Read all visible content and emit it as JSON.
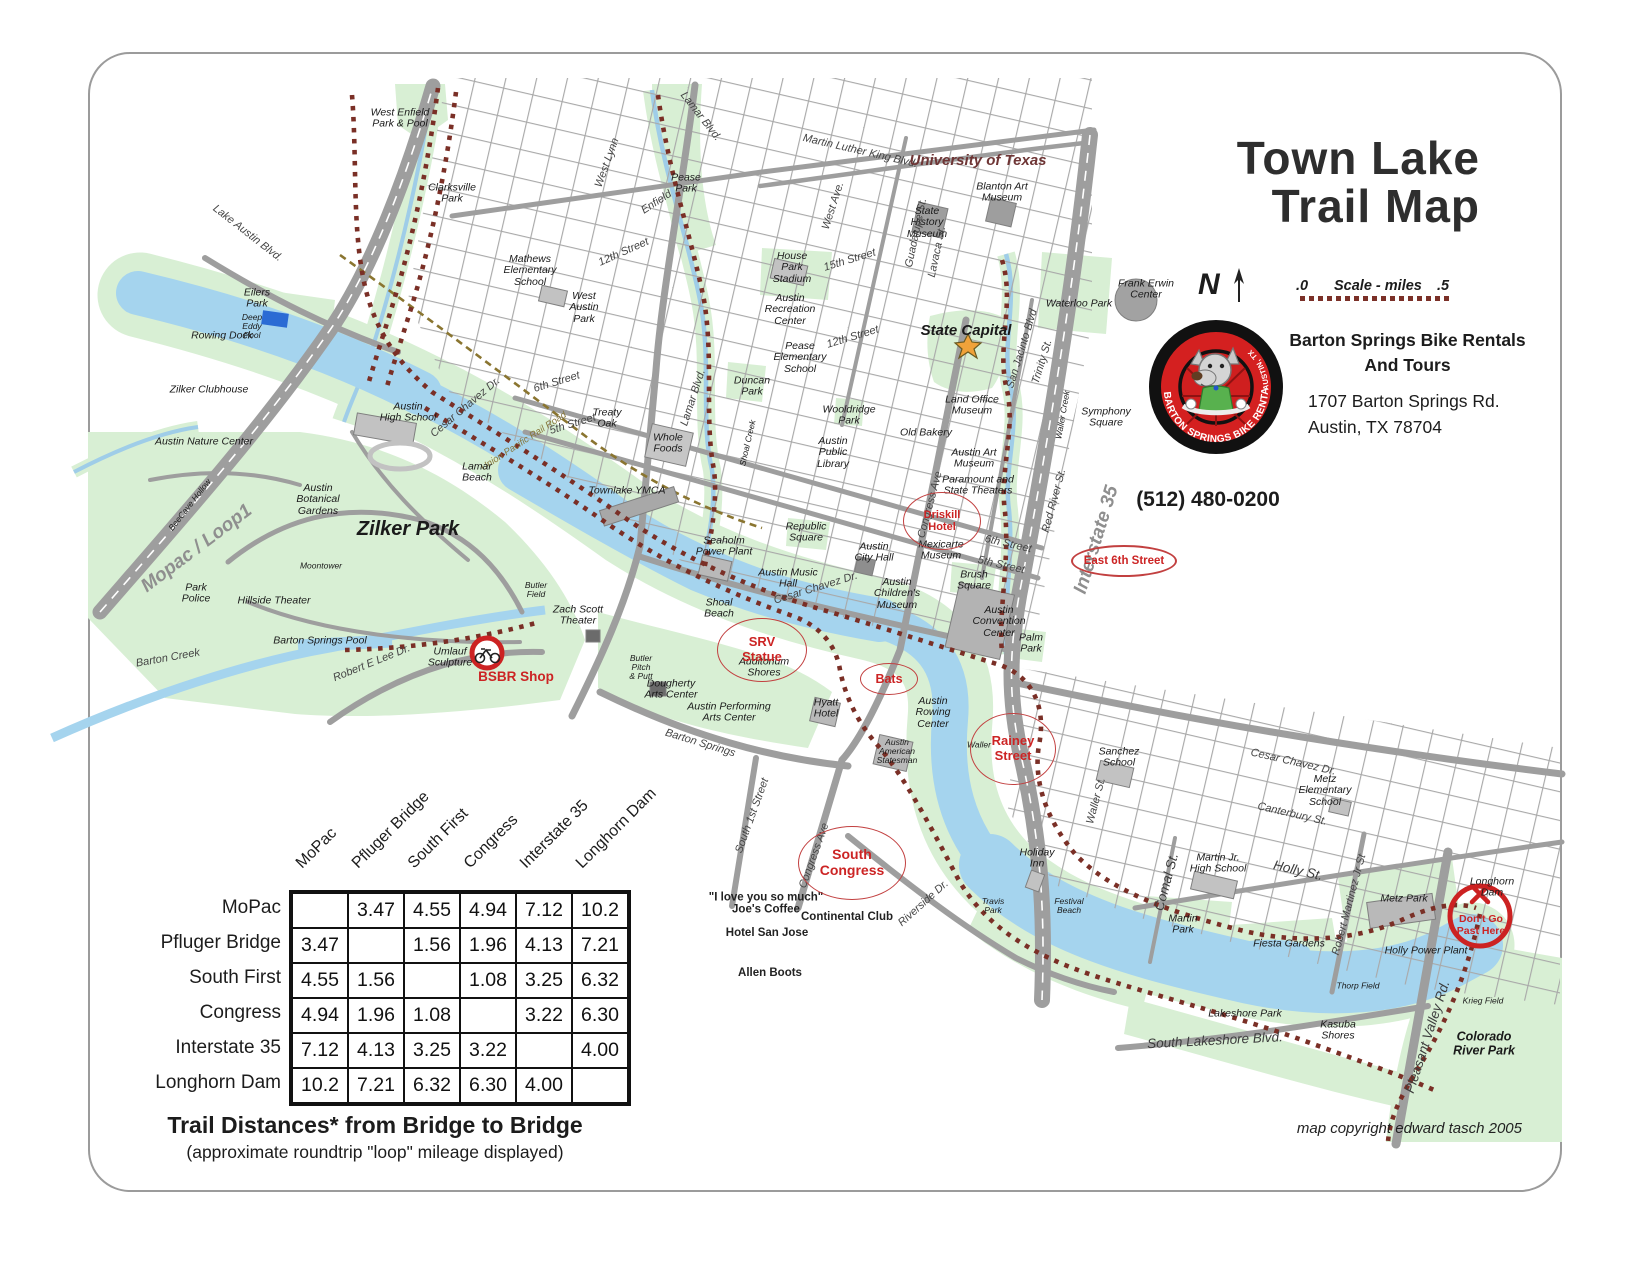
{
  "title": {
    "line1": "Town Lake",
    "line2": "Trail Map"
  },
  "compass": {
    "label": "N"
  },
  "scale": {
    "start": ".0",
    "label": "Scale - miles",
    "end": ".5"
  },
  "business": {
    "logo_ring_text": "BARTON SPRINGS BIKE RENTAL",
    "logo_side_text": "AUSTIN, TX",
    "name_line1": "Barton Springs Bike Rentals",
    "name_line2": "And Tours",
    "address_line1": "1707 Barton Springs Rd.",
    "address_line2": "Austin, TX 78704",
    "phone": "(512) 480-0200"
  },
  "distance_table": {
    "locations": [
      "MoPac",
      "Pfluger Bridge",
      "South First",
      "Congress",
      "Interstate 35",
      "Longhorn Dam"
    ],
    "matrix": [
      [
        "",
        "3.47",
        "4.55",
        "4.94",
        "7.12",
        "10.2"
      ],
      [
        "3.47",
        "",
        "1.56",
        "1.96",
        "4.13",
        "7.21"
      ],
      [
        "4.55",
        "1.56",
        "",
        "1.08",
        "3.25",
        "6.32"
      ],
      [
        "4.94",
        "1.96",
        "1.08",
        "",
        "3.22",
        "6.30"
      ],
      [
        "7.12",
        "4.13",
        "3.25",
        "3.22",
        "",
        "4.00"
      ],
      [
        "10.2",
        "7.21",
        "6.32",
        "6.30",
        "4.00",
        ""
      ]
    ],
    "caption": "Trail Distances* from Bridge to Bridge",
    "subcaption": "(approximate roundtrip \"loop\" mileage displayed)"
  },
  "copyright": "map copyright edward tasch 2005",
  "map": {
    "colors": {
      "water": "#a5d4ee",
      "park": "#d8efd4",
      "road": "#9e9e9e",
      "trail": "#7a2f26",
      "callout": "#cc2424"
    },
    "shop_marker": {
      "label": "BSBR Shop",
      "x": 516,
      "y": 678
    },
    "warning_marker": {
      "label": "Don't Go\nPast Here",
      "x": 1481,
      "y": 925
    },
    "callouts": [
      {
        "t": "Driskill\nHotel",
        "x": 941,
        "y": 520,
        "w": 76,
        "h": 56,
        "fs": 11,
        "bw": 1.3
      },
      {
        "t": "East 6th Street",
        "x": 1122,
        "y": 559,
        "w": 102,
        "h": 28,
        "fs": 11.5,
        "bw": 2.5
      },
      {
        "t": "SRV\nStatue",
        "x": 761,
        "y": 649,
        "w": 88,
        "h": 62,
        "fs": 13,
        "bw": 1.3
      },
      {
        "t": "Bats",
        "x": 888,
        "y": 678,
        "w": 56,
        "h": 30,
        "fs": 12.5,
        "bw": 1.4
      },
      {
        "t": "Rainey\nStreet",
        "x": 1012,
        "y": 748,
        "w": 84,
        "h": 70,
        "fs": 13,
        "bw": 1.4
      },
      {
        "t": "South\nCongress",
        "x": 851,
        "y": 862,
        "w": 106,
        "h": 72,
        "fs": 14,
        "bw": 1.7
      }
    ],
    "labels": [
      {
        "t": "West Enfield\nPark & Pool",
        "x": 400,
        "y": 119
      },
      {
        "t": "Clarksville\nPark",
        "x": 452,
        "y": 194
      },
      {
        "t": "Pease\nPark",
        "x": 686,
        "y": 184
      },
      {
        "t": "Lamar Blvd.",
        "x": 700,
        "y": 117,
        "r": 52,
        "c": "rd"
      },
      {
        "t": "West Lynn",
        "x": 608,
        "y": 163,
        "r": -70,
        "c": "rd"
      },
      {
        "t": "Enfield",
        "x": 657,
        "y": 203,
        "r": -33,
        "c": "rd"
      },
      {
        "t": "12th Street",
        "x": 624,
        "y": 253,
        "r": -24,
        "c": "rd"
      },
      {
        "t": "Mathews\nElementary\nSchool",
        "x": 530,
        "y": 271
      },
      {
        "t": "West\nAustin\nPark",
        "x": 584,
        "y": 308
      },
      {
        "t": "Martin Luther King Blvd.",
        "x": 860,
        "y": 152,
        "r": 13,
        "c": "rd"
      },
      {
        "t": "University of Texas",
        "x": 978,
        "y": 161,
        "c": "maroon"
      },
      {
        "t": "Blanton Art\nMuseum",
        "x": 1002,
        "y": 193
      },
      {
        "t": "State\nHistory\nMuseum",
        "x": 927,
        "y": 223
      },
      {
        "t": "West Ave.",
        "x": 834,
        "y": 206,
        "r": -72,
        "c": "rd"
      },
      {
        "t": "15th Street",
        "x": 850,
        "y": 261,
        "r": -17,
        "c": "rd"
      },
      {
        "t": "House\nPark\nStadium",
        "x": 792,
        "y": 268
      },
      {
        "t": "Guadalupe St.",
        "x": 917,
        "y": 233,
        "r": -78,
        "c": "rd"
      },
      {
        "t": "Lavaca St.",
        "x": 938,
        "y": 252,
        "r": -78,
        "c": "rd"
      },
      {
        "t": "Austin\nRecreation\nCenter",
        "x": 790,
        "y": 310
      },
      {
        "t": "Waterloo Park",
        "x": 1079,
        "y": 304
      },
      {
        "t": "Frank Erwin\nCenter",
        "x": 1146,
        "y": 290
      },
      {
        "t": "State Capital",
        "x": 966,
        "y": 331,
        "c": "lg"
      },
      {
        "t": "12th Street",
        "x": 853,
        "y": 338,
        "r": -17,
        "c": "rd"
      },
      {
        "t": "Pease\nElementary\nSchool",
        "x": 800,
        "y": 358
      },
      {
        "t": "San Jacinto Blvd",
        "x": 1023,
        "y": 349,
        "r": -73,
        "c": "rd"
      },
      {
        "t": "Trinity St.",
        "x": 1043,
        "y": 362,
        "r": -73,
        "c": "rd"
      },
      {
        "t": "Symphony\nSquare",
        "x": 1106,
        "y": 418
      },
      {
        "t": "Waller Creek",
        "x": 1063,
        "y": 415,
        "r": -80,
        "c": "xs"
      },
      {
        "t": "Lake Austin Blvd.",
        "x": 247,
        "y": 234,
        "r": 38,
        "c": "rd"
      },
      {
        "t": "Eilers\nPark",
        "x": 257,
        "y": 299
      },
      {
        "t": "Deep\nEddy\nPool",
        "x": 252,
        "y": 327,
        "c": "xs"
      },
      {
        "t": "Rowing Dock",
        "x": 222,
        "y": 336
      },
      {
        "t": "Zilker Clubhouse",
        "x": 209,
        "y": 390
      },
      {
        "t": "Austin Nature Center",
        "x": 204,
        "y": 442
      },
      {
        "t": "Austin\nHigh School",
        "x": 408,
        "y": 413
      },
      {
        "t": "Cesar Chavez Dr.",
        "x": 466,
        "y": 408,
        "r": -40,
        "c": "rd"
      },
      {
        "t": "Union Pacific Rail Road",
        "x": 524,
        "y": 442,
        "r": -33,
        "c": "rr"
      },
      {
        "t": "BeeCave Hollow",
        "x": 190,
        "y": 505,
        "r": -52,
        "c": "xs"
      },
      {
        "t": "Mopac / Loop1",
        "x": 197,
        "y": 549,
        "r": -37,
        "c": "hwy"
      },
      {
        "t": "Austin\nBotanical\nGardens",
        "x": 318,
        "y": 500
      },
      {
        "t": "Zilker Park",
        "x": 408,
        "y": 530,
        "c": "xl"
      },
      {
        "t": "Moontower",
        "x": 321,
        "y": 566,
        "c": "xs"
      },
      {
        "t": "Park\nPolice",
        "x": 196,
        "y": 594
      },
      {
        "t": "Hillside Theater",
        "x": 274,
        "y": 601
      },
      {
        "t": "Barton Springs Pool",
        "x": 320,
        "y": 641
      },
      {
        "t": "Barton Creek",
        "x": 168,
        "y": 659,
        "r": -10,
        "c": "rd"
      },
      {
        "t": "Robert E Lee Dr.",
        "x": 372,
        "y": 664,
        "r": -22,
        "c": "rd"
      },
      {
        "t": "Umlauf\nSculpture",
        "x": 450,
        "y": 658
      },
      {
        "t": "Zach Scott\nTheater",
        "x": 578,
        "y": 616
      },
      {
        "t": "Butler\nField",
        "x": 536,
        "y": 590,
        "c": "xs"
      },
      {
        "t": "Lamar\nBeach",
        "x": 477,
        "y": 473
      },
      {
        "t": "Townlake YMCA",
        "x": 627,
        "y": 491
      },
      {
        "t": "6th Street",
        "x": 557,
        "y": 383,
        "r": -17,
        "c": "rd"
      },
      {
        "t": "5th Street",
        "x": 573,
        "y": 425,
        "r": -17,
        "c": "rd"
      },
      {
        "t": "Lamar Blvd.",
        "x": 694,
        "y": 398,
        "r": -72,
        "c": "rd"
      },
      {
        "t": "Treaty\nOak",
        "x": 607,
        "y": 419
      },
      {
        "t": "Whole\nFoods",
        "x": 668,
        "y": 444
      },
      {
        "t": "Duncan\nPark",
        "x": 752,
        "y": 387
      },
      {
        "t": "Shoal Creek",
        "x": 748,
        "y": 443,
        "r": -77,
        "c": "xs"
      },
      {
        "t": "Seaholm\nPower Plant",
        "x": 724,
        "y": 547
      },
      {
        "t": "Republic\nSquare",
        "x": 806,
        "y": 533
      },
      {
        "t": "Wooldridge\nPark",
        "x": 849,
        "y": 416
      },
      {
        "t": "Austin\nPublic\nLibrary",
        "x": 833,
        "y": 453
      },
      {
        "t": "Old Bakery",
        "x": 926,
        "y": 433
      },
      {
        "t": "Land Office\nMuseum",
        "x": 972,
        "y": 406
      },
      {
        "t": "Austin Art\nMuseum",
        "x": 974,
        "y": 459
      },
      {
        "t": "Paramount and\nState Theaters",
        "x": 978,
        "y": 486
      },
      {
        "t": "Congress Ave",
        "x": 931,
        "y": 505,
        "r": -75,
        "c": "rd"
      },
      {
        "t": "Red River St.",
        "x": 1055,
        "y": 501,
        "r": -75,
        "c": "rd"
      },
      {
        "t": "Interstate 35",
        "x": 1097,
        "y": 540,
        "r": -73,
        "c": "hwy"
      },
      {
        "t": "Austin\nCity Hall",
        "x": 874,
        "y": 553
      },
      {
        "t": "Mexicarte\nMuseum",
        "x": 941,
        "y": 551
      },
      {
        "t": "6th Street",
        "x": 1008,
        "y": 545,
        "r": 13,
        "c": "rd"
      },
      {
        "t": "5th Street",
        "x": 1001,
        "y": 566,
        "r": 13,
        "c": "rd"
      },
      {
        "t": "Brush\nSquare",
        "x": 974,
        "y": 581
      },
      {
        "t": "Austin\nChildren's\nMuseum",
        "x": 897,
        "y": 594
      },
      {
        "t": "Austin\nConvention\nCenter",
        "x": 999,
        "y": 622
      },
      {
        "t": "Palm\nPark",
        "x": 1031,
        "y": 644
      },
      {
        "t": "Cesar Chavez Dr.",
        "x": 816,
        "y": 589,
        "r": -17,
        "c": "rd"
      },
      {
        "t": "Austin Music\nHall",
        "x": 788,
        "y": 579
      },
      {
        "t": "Shoal\nBeach",
        "x": 719,
        "y": 609
      },
      {
        "t": "Auditorium\nShores",
        "x": 764,
        "y": 668
      },
      {
        "t": "Hyatt\nHotel",
        "x": 826,
        "y": 709
      },
      {
        "t": "Austin\nRowing\nCenter",
        "x": 933,
        "y": 713
      },
      {
        "t": "Austin\nAmerican\nStatesman",
        "x": 897,
        "y": 752,
        "c": "xs"
      },
      {
        "t": "Dougherty\nArts Center",
        "x": 671,
        "y": 690
      },
      {
        "t": "Austin Performing\nArts Center",
        "x": 729,
        "y": 713
      },
      {
        "t": "Butler\nPitch\n& Putt",
        "x": 641,
        "y": 668,
        "c": "xs"
      },
      {
        "t": "Barton Springs",
        "x": 700,
        "y": 744,
        "r": 17,
        "c": "rd"
      },
      {
        "t": "South 1st Street",
        "x": 753,
        "y": 816,
        "r": -70,
        "c": "rd"
      },
      {
        "t": "Congress Ave",
        "x": 815,
        "y": 856,
        "r": -70,
        "c": "rd"
      },
      {
        "t": "Riverside Dr.",
        "x": 924,
        "y": 904,
        "r": -42,
        "c": "rd"
      },
      {
        "t": "\"I love you so much\"\nJoe's Coffee",
        "x": 766,
        "y": 904,
        "c": "sb"
      },
      {
        "t": "Continental Club",
        "x": 847,
        "y": 917,
        "c": "sb"
      },
      {
        "t": "Hotel San Jose",
        "x": 767,
        "y": 933,
        "c": "sb"
      },
      {
        "t": "Allen Boots",
        "x": 770,
        "y": 973,
        "c": "sb"
      },
      {
        "t": "Waller",
        "x": 979,
        "y": 745,
        "c": "xs"
      },
      {
        "t": "Holiday\nInn",
        "x": 1037,
        "y": 859
      },
      {
        "t": "Sanchez\nSchool",
        "x": 1119,
        "y": 758
      },
      {
        "t": "Waller St.",
        "x": 1097,
        "y": 801,
        "r": -75,
        "c": "rd"
      },
      {
        "t": "Cesar Chavez Dr.",
        "x": 1293,
        "y": 763,
        "r": 13,
        "c": "rd"
      },
      {
        "t": "Canterbury St.",
        "x": 1292,
        "y": 815,
        "r": 13,
        "c": "rd"
      },
      {
        "t": "Holly St.",
        "x": 1298,
        "y": 871,
        "r": 13,
        "c": "rd2"
      },
      {
        "t": "Comal St.",
        "x": 1167,
        "y": 882,
        "r": -75,
        "c": "rd2"
      },
      {
        "t": "Martin Jr.\nHigh School",
        "x": 1218,
        "y": 864
      },
      {
        "t": "Metz\nElementary\nSchool",
        "x": 1325,
        "y": 791
      },
      {
        "t": "Robert Martinez Jr St",
        "x": 1350,
        "y": 905,
        "r": -75,
        "c": "rd"
      },
      {
        "t": "Metz Park",
        "x": 1404,
        "y": 899
      },
      {
        "t": "Martin\nPark",
        "x": 1183,
        "y": 925
      },
      {
        "t": "Fiesta Gardens",
        "x": 1289,
        "y": 944
      },
      {
        "t": "Holly Power Plant",
        "x": 1426,
        "y": 951
      },
      {
        "t": "Thorp Field",
        "x": 1358,
        "y": 986,
        "c": "xs"
      },
      {
        "t": "Travis\nPark",
        "x": 993,
        "y": 906,
        "c": "xs"
      },
      {
        "t": "Festival\nBeach",
        "x": 1069,
        "y": 906,
        "c": "xs"
      },
      {
        "t": "Lakeshore Park",
        "x": 1245,
        "y": 1014
      },
      {
        "t": "South Lakeshore Blvd.",
        "x": 1215,
        "y": 1041,
        "r": -3,
        "c": "rd2"
      },
      {
        "t": "Kasuba\nShores",
        "x": 1338,
        "y": 1031
      },
      {
        "t": "Pleasant Valley Rd.",
        "x": 1428,
        "y": 1037,
        "r": -72,
        "c": "rd2"
      },
      {
        "t": "Longhorn\nDam",
        "x": 1492,
        "y": 888
      },
      {
        "t": "Krieg Field",
        "x": 1483,
        "y": 1001,
        "c": "xs"
      },
      {
        "t": "Colorado\nRiver Park",
        "x": 1484,
        "y": 1044,
        "c": "b"
      }
    ]
  }
}
